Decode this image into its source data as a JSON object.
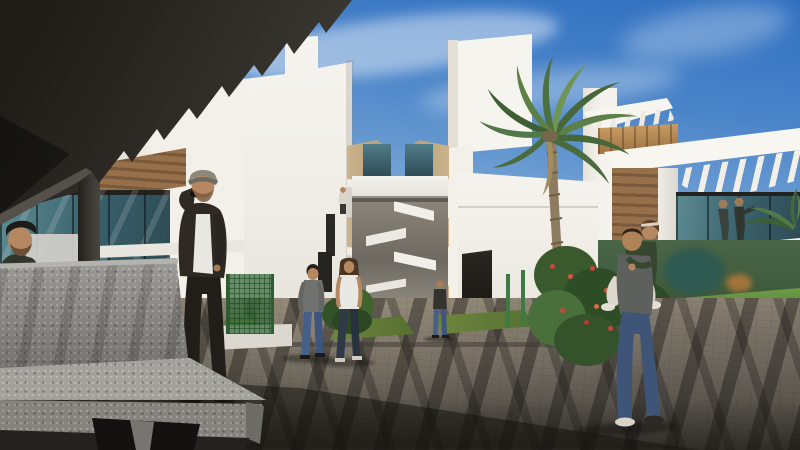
{
  "scene": {
    "type": "architectural-3d-render",
    "setting": "Modern white apartment complex plaza with palm tree, pergola canopy, concrete bench and pedestrians under a blue sky",
    "environment": [
      "pergola-canopy-top-left",
      "left-terrace-glass-balustrade",
      "left-apartment-building-with-balconies",
      "central-walkway-with-bridge-and-stairs",
      "right-apartment-building-with-balconies",
      "roof-terrace-villa-right",
      "wooden-roof-box",
      "palm-tree",
      "green-mesh-fence",
      "flowering-bushes",
      "grass-strips",
      "paved-plaza-with-diagonal-shadows",
      "concrete-bench-foreground"
    ],
    "people": [
      {
        "id": "man-leaning-at-bench",
        "appearance": "dark beret, beard, olive jacket, far left behind bench"
      },
      {
        "id": "man-on-phone",
        "appearance": "gray flat cap, dark open jacket, white shirt, dark trousers, phone to ear"
      },
      {
        "id": "walking-man",
        "appearance": "gray long-sleeve shirt, blue jeans"
      },
      {
        "id": "walking-woman",
        "appearance": "white top, dark jeans, long brown hair"
      },
      {
        "id": "man-in-alley",
        "appearance": "distant man, dark t-shirt, jeans"
      },
      {
        "id": "piggyback-man",
        "appearance": "gray t-shirt, blue jeans, carrying woman"
      },
      {
        "id": "piggyback-woman",
        "appearance": "dark green top, white rolled pants, headband"
      },
      {
        "id": "rooftop-couple",
        "appearance": "two figures on villa roof terrace, one pointing"
      },
      {
        "id": "balcony-person",
        "appearance": "small figure on first-floor balcony"
      }
    ]
  },
  "palette": {
    "sky_top": "#2f6fc0",
    "cloud_white": "#ffffff",
    "canopy_dark": "#2b2722",
    "pillar_gray": "#3a3631",
    "wall_white": "#f6f4ef",
    "wall_shade": "#e2ded6",
    "soffit_tan": "#c6ae85",
    "glass_teal_dark": "#2d4b55",
    "glass_teal_light": "#5d8b92",
    "wood_brown": "#96704a",
    "wood_dark": "#7a583a",
    "wood_box": "#c89a62",
    "ground_light": "#8a8172",
    "ground_dark": "#47433d",
    "shadow_dark": "#1a1714",
    "grass_green": "#65803c",
    "garden_green": "#3f5c33",
    "flower_pink": "#d584a8",
    "flower_red": "#c2483c",
    "concrete_light": "#a3a19c",
    "concrete_mid": "#8f8d89",
    "concrete_dark": "#5e5c58",
    "denim_blue": "#45608c",
    "skin_tan": "#b58862",
    "shirt_white": "#e9e7e1",
    "tee_gray": "#66696a",
    "cap_gray": "#8d8779",
    "jacket_dark": "#2e2923",
    "green_top": "#36462f"
  }
}
